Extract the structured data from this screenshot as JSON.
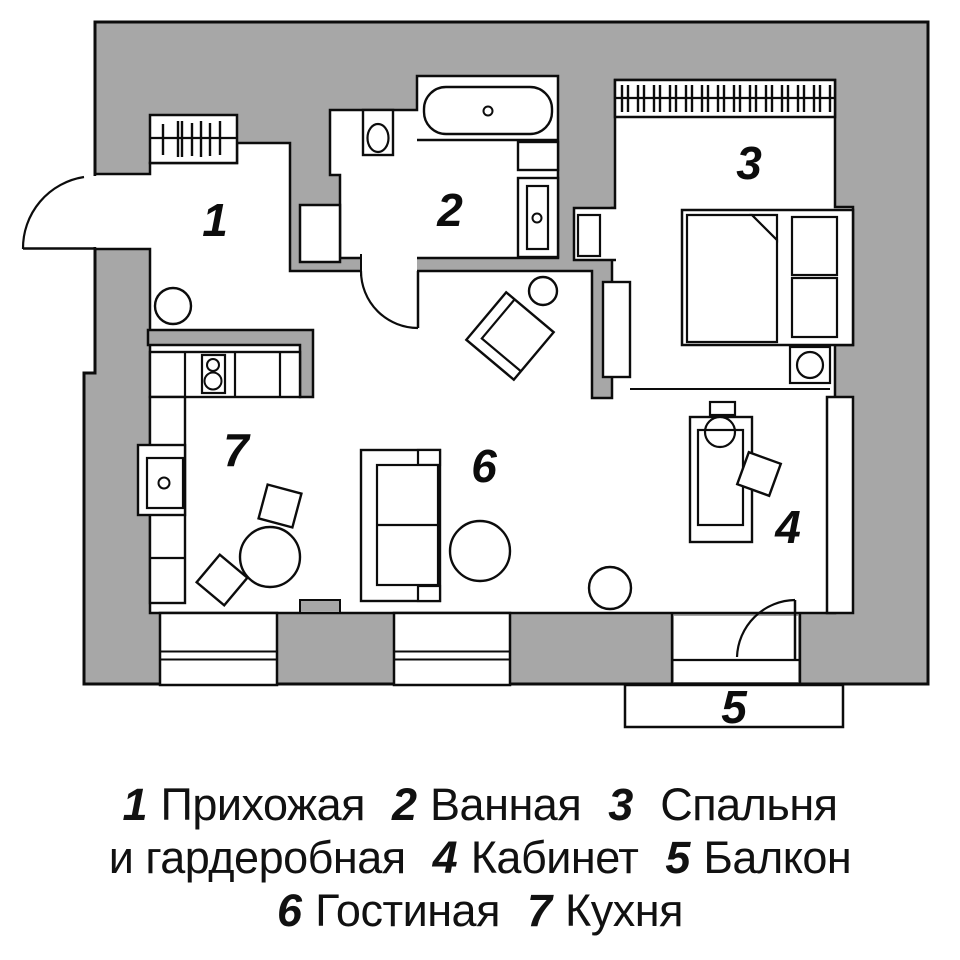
{
  "plan": {
    "type": "apartment-floor-plan",
    "rooms": [
      {
        "number": "1",
        "name": "Прихожая"
      },
      {
        "number": "2",
        "name": "Ванная"
      },
      {
        "number": "3",
        "name": "Спальня и гардеробная"
      },
      {
        "number": "4",
        "name": "Кабинет"
      },
      {
        "number": "5",
        "name": "Балкон"
      },
      {
        "number": "6",
        "name": "Гостиная"
      },
      {
        "number": "7",
        "name": "Кухня"
      }
    ]
  },
  "colors": {
    "wall_fill": "#a7a7a7",
    "line": "#0c0c0c",
    "background": "#ffffff"
  },
  "legend": {
    "lines": [
      {
        "parts": [
          {
            "text": "1",
            "style": "num"
          },
          {
            "text": "Прихожая",
            "style": "word"
          },
          {
            "text": "2",
            "style": "num"
          },
          {
            "text": "Ванная",
            "style": "word"
          },
          {
            "text": "3",
            "style": "num"
          },
          {
            "text": "Спальня",
            "style": "word"
          }
        ]
      },
      {
        "parts": [
          {
            "text": "и гардеробная",
            "style": "word"
          },
          {
            "text": "4",
            "style": "num"
          },
          {
            "text": "Кабинет",
            "style": "word"
          },
          {
            "text": "5",
            "style": "num"
          },
          {
            "text": "Балкон",
            "style": "word"
          }
        ]
      },
      {
        "parts": [
          {
            "text": "6",
            "style": "num"
          },
          {
            "text": "Гостиная",
            "style": "word"
          },
          {
            "text": "7",
            "style": "num"
          },
          {
            "text": "Кухня",
            "style": "word"
          }
        ]
      }
    ]
  }
}
